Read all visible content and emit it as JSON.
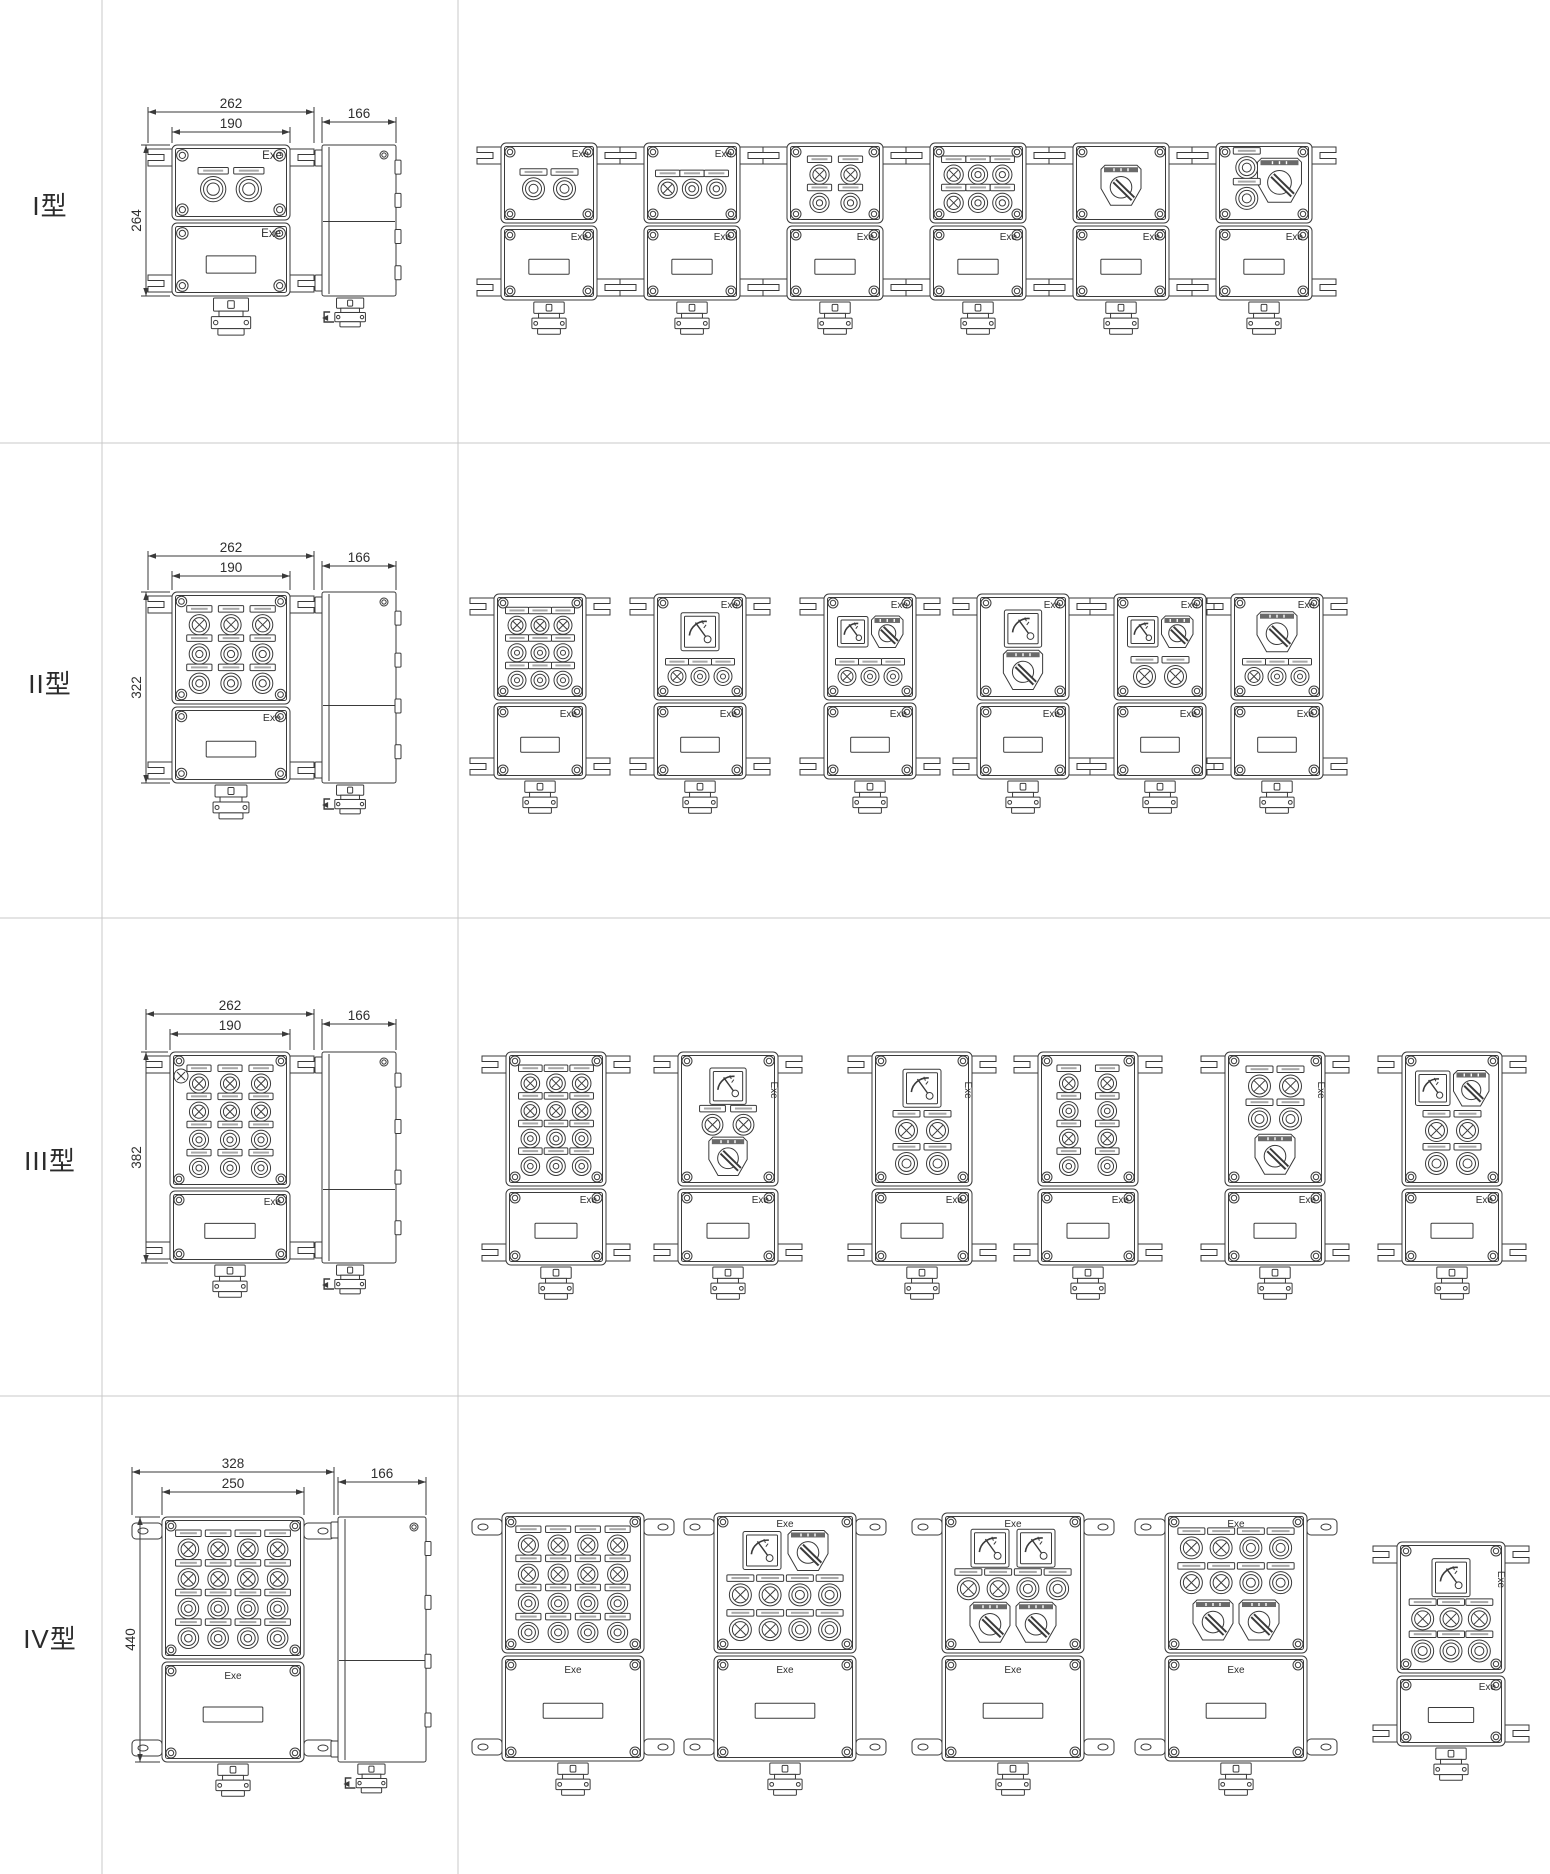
{
  "page_title": "Explosion-proof control box type catalog drawings",
  "colors": {
    "background": "#ffffff",
    "line": "#3a3a3a",
    "divider": "#c8c8c8",
    "text": "#2b2b2b"
  },
  "exe_label": "Exe",
  "rows": [
    {
      "id": "I",
      "label": "I型",
      "dims": {
        "overall_width": "262",
        "inner_width": "190",
        "height": "264",
        "depth": "166"
      },
      "master": {
        "panel": "BB",
        "exe": [
          "top-right",
          "bottom-right"
        ]
      },
      "variants": [
        {
          "panel": "BB",
          "exe": [
            "top-right",
            "bottom-right"
          ]
        },
        {
          "panel": "LBB",
          "exe": [
            "top-right",
            "bottom-right"
          ]
        },
        {
          "panel": "LL|BB",
          "exe": [
            "bottom-right"
          ]
        },
        {
          "panel": "LBB|LBB",
          "exe": [
            "bottom-right"
          ]
        },
        {
          "panel": "R",
          "exe": [
            "bottom-right"
          ]
        },
        {
          "panel": "BR|B",
          "exe": [
            "bottom-right"
          ]
        }
      ]
    },
    {
      "id": "II",
      "label": "II型",
      "dims": {
        "overall_width": "262",
        "inner_width": "190",
        "height": "322",
        "depth": "166"
      },
      "master": {
        "panel": "LLL|BBB|BBB",
        "exe": [
          "bottom-right"
        ]
      },
      "variants": [
        {
          "panel": "LLL|BBB|BBB",
          "exe": [
            "bottom-right"
          ]
        },
        {
          "panel": "M|LBB",
          "exe": [
            "top-right",
            "bottom-right"
          ]
        },
        {
          "panel": "MR|LBB",
          "exe": [
            "top-right",
            "bottom-right"
          ]
        },
        {
          "panel": "M|R",
          "exe": [
            "top-right",
            "bottom-right"
          ]
        },
        {
          "panel": "MR|LL",
          "exe": [
            "top-right",
            "bottom-right"
          ]
        },
        {
          "panel": "R|LBB",
          "exe": [
            "top-right",
            "bottom-right"
          ]
        }
      ]
    },
    {
      "id": "III",
      "label": "III型",
      "dims": {
        "overall_width": "262",
        "inner_width": "190",
        "height": "382",
        "depth": "166"
      },
      "master": {
        "panel": "LLL|LLL|BBB|BBB",
        "corner_lamp": true,
        "exe": [
          "bottom-right"
        ]
      },
      "variants": [
        {
          "panel": "LLL|LLL|BBB|BBB",
          "exe": [
            "bottom-right"
          ]
        },
        {
          "panel": "M|LL|R",
          "exe": [
            "right-vertical",
            "bottom-right"
          ]
        },
        {
          "panel": "M|LL|BB",
          "exe": [
            "right-vertical",
            "bottom-right"
          ]
        },
        {
          "panel": "LL|BB|LL|BB",
          "exe": [
            "bottom-right"
          ]
        },
        {
          "panel": "LL|BB|R",
          "exe": [
            "right-vertical",
            "bottom-right"
          ]
        },
        {
          "panel": "MR|LL|BB",
          "exe": [
            "bottom-right"
          ]
        }
      ]
    },
    {
      "id": "IV",
      "label": "IV型",
      "dims": {
        "overall_width": "328",
        "inner_width": "250",
        "height": "440",
        "depth": "166"
      },
      "master": {
        "panel": "LLLL|LLLL|BBBB|BBBB",
        "exe": [
          "bottom-center"
        ]
      },
      "variants": [
        {
          "panel": "LLLL|LLLL|BBBB|BBBB",
          "exe": [
            "bottom-center"
          ]
        },
        {
          "panel": "MR|LLBB|LLBB",
          "exe": [
            "top-center",
            "bottom-center"
          ]
        },
        {
          "panel": "MM|LLBB|RR",
          "exe": [
            "top-center",
            "bottom-center"
          ]
        },
        {
          "panel": "LLBB|LLBB|RR",
          "exe": [
            "top-center",
            "bottom-center"
          ]
        },
        {
          "panel": "M|LLL|BBB",
          "exe": [
            "right-vertical",
            "bottom-right"
          ]
        }
      ]
    }
  ]
}
